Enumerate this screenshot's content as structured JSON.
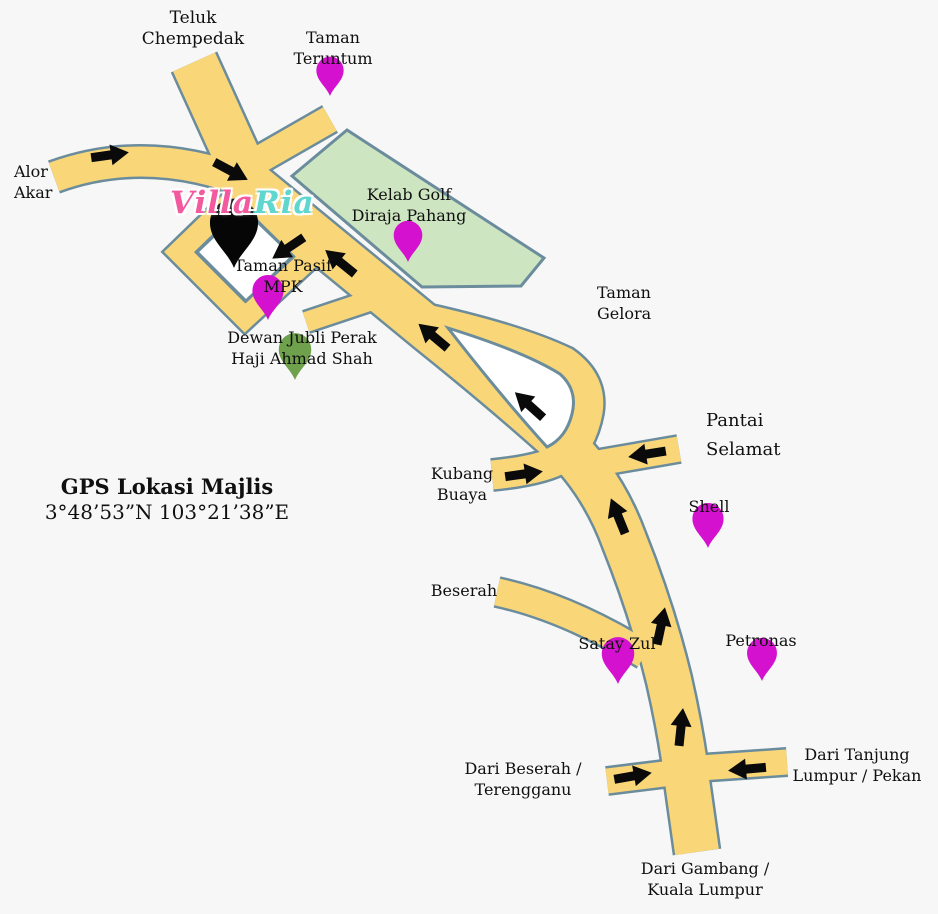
{
  "title": "Villa Ria location map",
  "logo": {
    "villa": "Villa",
    "ria": "Ria"
  },
  "gps": {
    "title": "GPS Lokasi Majlis",
    "coords": "3°48’53”N 103°21’38”E"
  },
  "labels": {
    "teluk_chempedak": {
      "line1": "Teluk",
      "line2": "Chempedak"
    },
    "taman_teruntum": {
      "line1": "Taman",
      "line2": "Teruntum"
    },
    "alor_akar": {
      "line1": "Alor",
      "line2": "Akar"
    },
    "kelab_golf": {
      "line1": "Kelab Golf",
      "line2": "Diraja Pahang"
    },
    "taman_gelora": {
      "line1": "Taman",
      "line2": "Gelora"
    },
    "taman_pasif": {
      "line1": "Taman Pasif",
      "line2": "MPK"
    },
    "dewan_jubli": {
      "line1": "Dewan Jubli Perak",
      "line2": "Haji Ahmad Shah"
    },
    "pantai_selamat": {
      "line1": "Pantai",
      "line2": "Selamat"
    },
    "kubang_buaya": {
      "line1": "Kubang",
      "line2": "Buaya"
    },
    "shell": {
      "line1": "Shell"
    },
    "beserah": {
      "line1": "Beserah"
    },
    "satay_zul": {
      "line1": "Satay Zul"
    },
    "petronas": {
      "line1": "Petronas"
    },
    "dari_beserah": {
      "line1": "Dari Beserah /",
      "line2": "Terengganu"
    },
    "dari_tanjung": {
      "line1": "Dari Tanjung",
      "line2": "Lumpur / Pekan"
    },
    "dari_gambang": {
      "line1": "Dari Gambang /",
      "line2": "Kuala Lumpur"
    }
  },
  "pins": {
    "teruntum": {
      "color": "#D411CE"
    },
    "kelab": {
      "color": "#D411CE"
    },
    "mpk": {
      "color": "#D411CE"
    },
    "shell": {
      "color": "#D411CE"
    },
    "satay": {
      "color": "#D411CE"
    },
    "petronas": {
      "color": "#D411CE"
    },
    "dewan": {
      "color": "#6FA04B"
    },
    "villa_ria": {
      "color": "#060606"
    }
  },
  "colors": {
    "background": "#F7F7F7",
    "road_fill": "#F9D678",
    "road_outline": "#6B8C9C",
    "park_fill": "#CEE5C2",
    "loop_interior": "#FFFFFF",
    "arrow": "#0A0A0A",
    "label_text": "#101010",
    "logo_pink": "#F2599E",
    "logo_teal": "#5FD6CE"
  }
}
